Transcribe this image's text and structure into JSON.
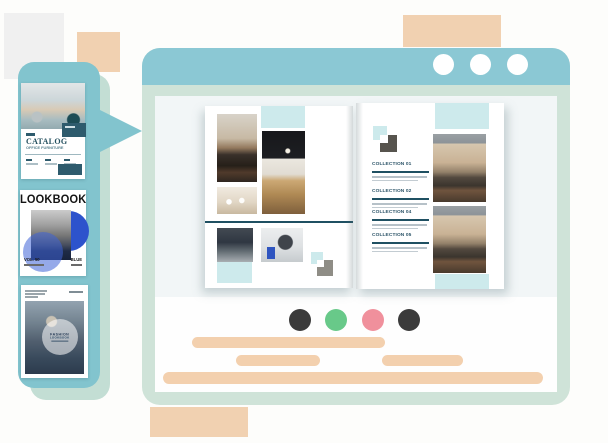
{
  "decor": {
    "peach_color": "#f1d1b1",
    "gray_color": "#f0f0f0"
  },
  "sidebar": {
    "panel_color": "#82c4ce",
    "shadow_color": "#c3ded4",
    "thumbnails": [
      {
        "title": "CATALOG",
        "subtitle": "OFFICE FURNITURE"
      },
      {
        "title": "LOOKBOOK",
        "volume": "VOL. 50",
        "tag": "BLUE"
      },
      {
        "circle_title": "FASHION",
        "circle_subtitle": "LOOKBOOK"
      }
    ]
  },
  "window": {
    "titlebar_color": "#8bc8d4",
    "frame_color": "#cfe3d8",
    "control_icon": "window-control-dot",
    "nav_dots": [
      {
        "name": "nav-dot-1",
        "color": "#3b3b3b"
      },
      {
        "name": "nav-dot-2",
        "color": "#68c989"
      },
      {
        "name": "nav-dot-3",
        "color": "#f0909c"
      },
      {
        "name": "nav-dot-4",
        "color": "#3b3b3b"
      }
    ],
    "placeholder_color": "#f3d0ae"
  },
  "book": {
    "accent_color": "#cdeaec",
    "rule_color": "#1f5062",
    "collections": [
      {
        "label": "COLLECTION 01"
      },
      {
        "label": "COLLECTION 02"
      },
      {
        "label": "COLLECTION 04"
      },
      {
        "label": "COLLECTION 05"
      }
    ]
  }
}
